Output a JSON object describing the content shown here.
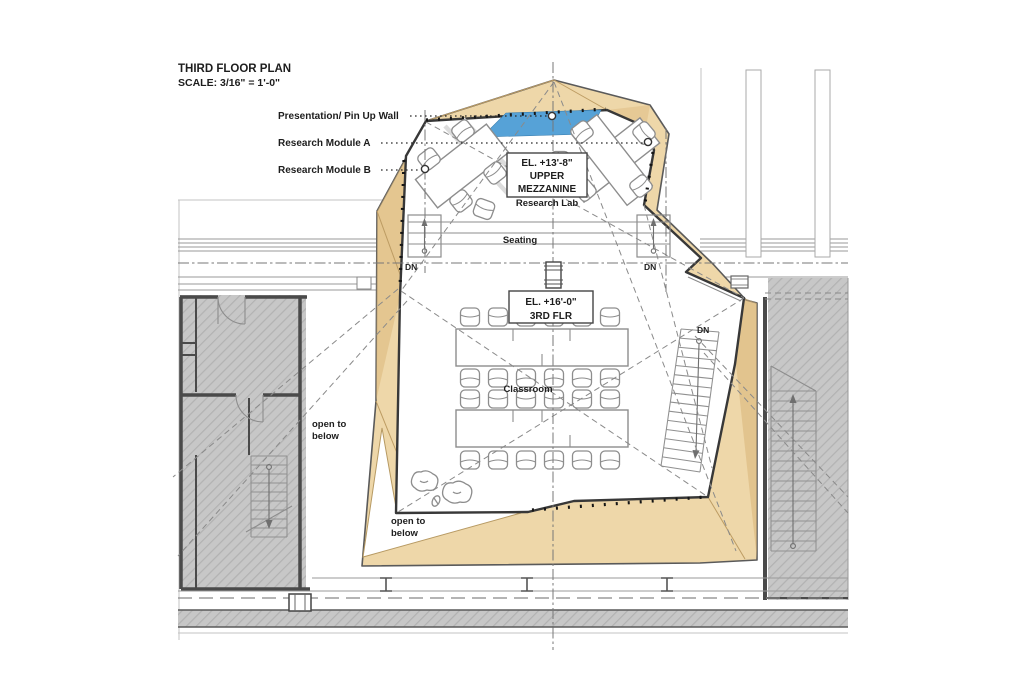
{
  "drawing": {
    "title": "THIRD FLOOR PLAN",
    "scale": "SCALE:  3/16\" = 1'-0\"",
    "leaders": {
      "pin_up_wall": "Presentation/ Pin Up Wall",
      "module_a": "Research Module A",
      "module_b": "Research Module B"
    },
    "mezzanine_tag": {
      "elevation": "EL. +13'-8\"",
      "name1": "UPPER",
      "name2": "MEZZANINE",
      "subtitle": "Research Lab"
    },
    "third_floor_tag": {
      "elevation": "EL. +16'-0\"",
      "name": "3RD FLR"
    },
    "areas": {
      "seating": "Seating",
      "classroom": "Classroom"
    },
    "open_to_below": {
      "line1": "open to",
      "line2": "below"
    },
    "stair_down": "DN"
  },
  "colors": {
    "wood": "#eed7a9",
    "wood_dark": "#d9b578",
    "accent_blue": "#56a2d7",
    "hatch_gray": "#c7c7c7",
    "wall_dark": "#4a4a4a",
    "line_gray": "#9a9a9a",
    "outline": "#383838"
  }
}
